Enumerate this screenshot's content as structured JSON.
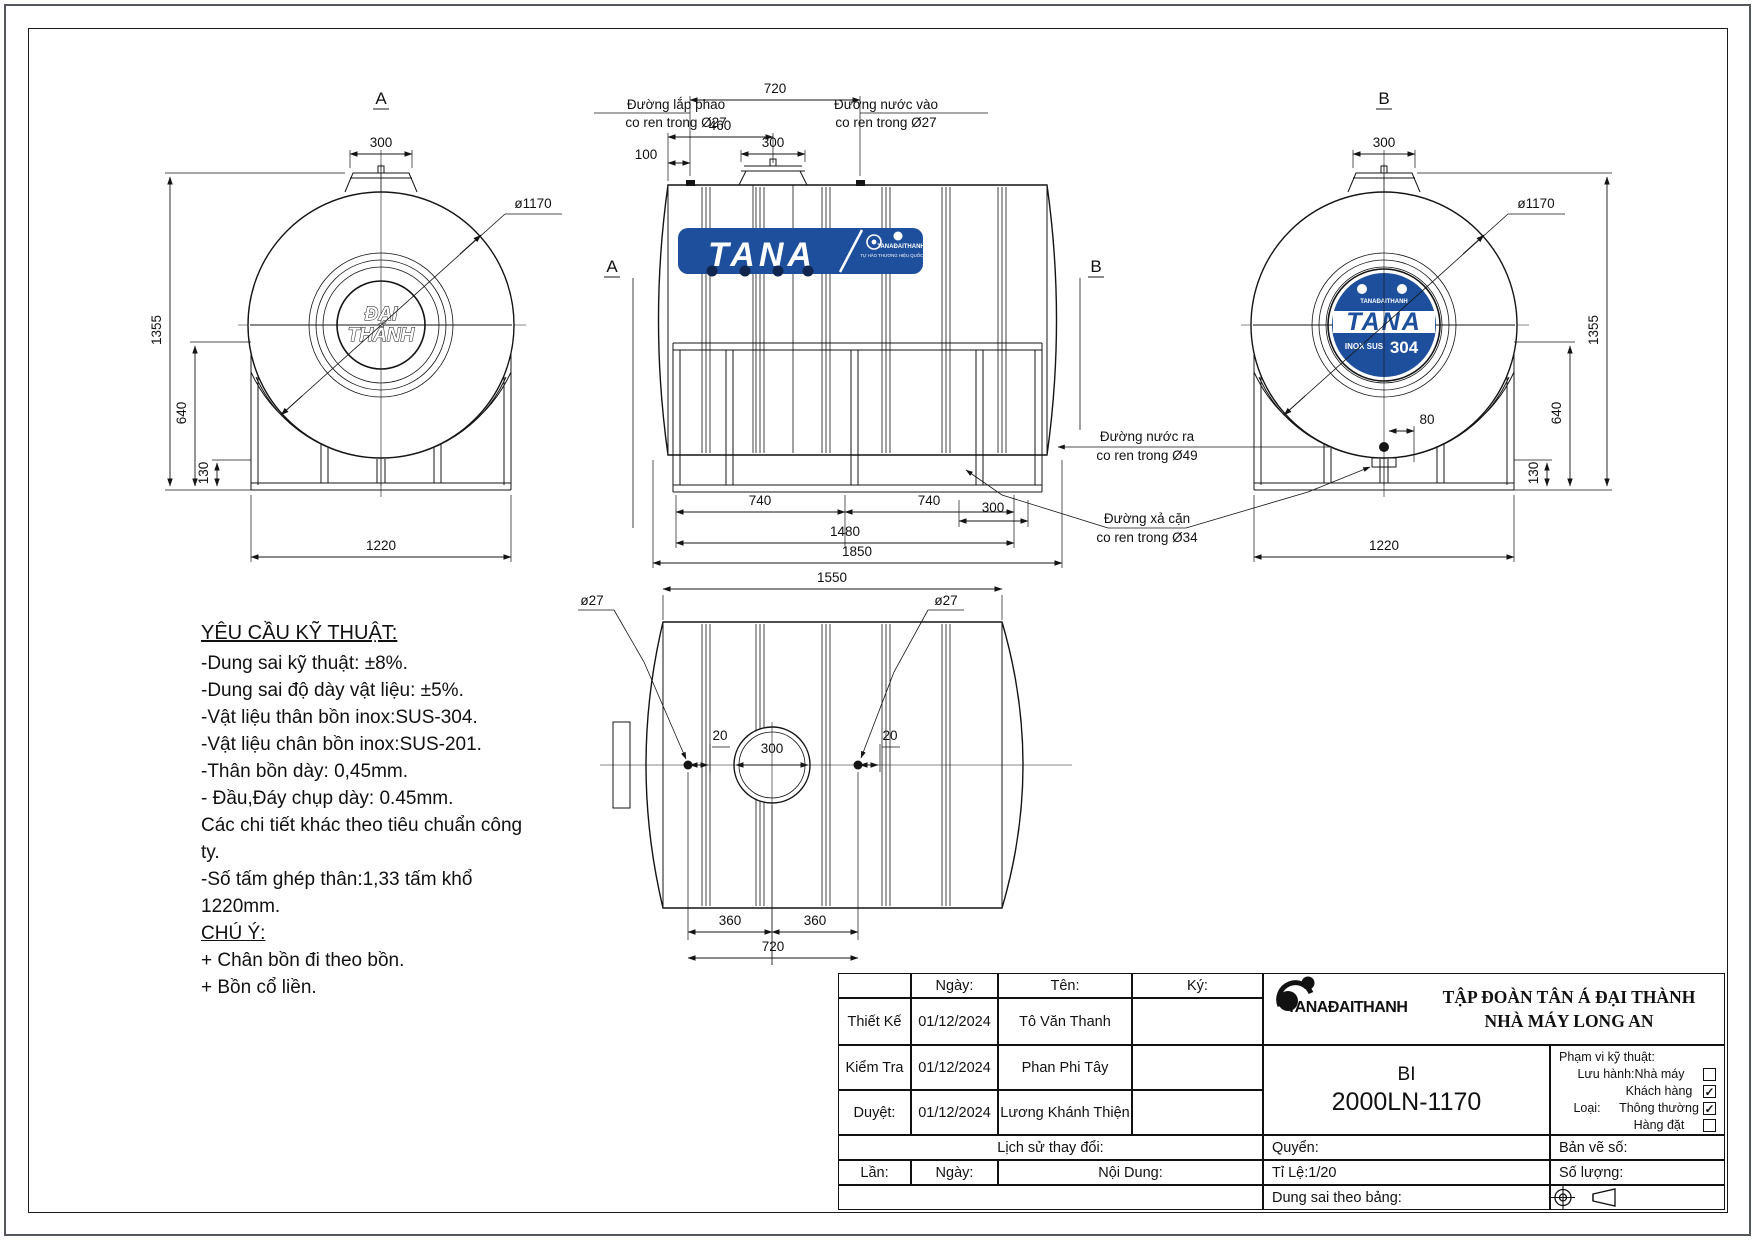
{
  "colors": {
    "brand_blue": "#1e4f9c",
    "line": "#141414",
    "background": "#ffffff"
  },
  "drawing": {
    "view_a": {
      "label": "A",
      "logo": [
        "ĐẠI",
        "THÀNH"
      ],
      "dims": {
        "lid": "300",
        "diameter": "ø1170",
        "height": "1355",
        "stand": "640",
        "leg": "130",
        "width": "1220"
      }
    },
    "front": {
      "brand": {
        "name": "TANA",
        "sub1": "TANAĐAITHANH",
        "sub2": "TỰ HÀO THƯƠNG HIỆU QUỐC GIA"
      },
      "labels": {
        "section_a": "A",
        "section_b": "B",
        "phao": [
          "Đường lắp phao",
          "co ren trong Ø27"
        ],
        "inlet": [
          "Đường nước vào",
          "co ren trong Ø27"
        ],
        "outlet": [
          "Đường nước ra",
          "co ren trong Ø49"
        ],
        "drain": [
          "Đường xả cặn",
          "co ren trong Ø34"
        ]
      },
      "dims": {
        "span": "720",
        "to_manhole": "460",
        "lid": "300",
        "end": "100",
        "leg_a": "740",
        "leg_b": "740",
        "drain": "300",
        "legs_span": "1480",
        "length": "1850"
      }
    },
    "view_b": {
      "label": "B",
      "brand": {
        "name": "TANA",
        "tiny": "TANAĐAITHANH",
        "inox": "INOX SUS",
        "grade": "304"
      },
      "dims": {
        "lid": "300",
        "diameter": "ø1170",
        "offset": "80",
        "height": "1355",
        "stand": "640",
        "leg": "130",
        "width": "1220"
      }
    },
    "top": {
      "dims": {
        "length": "1550",
        "hole": "300",
        "pitch_a": "360",
        "pitch_b": "360",
        "span": "720",
        "offset_l": "20",
        "offset_r": "20",
        "fitting_l": "ø27",
        "fitting_r": "ø27"
      }
    }
  },
  "tech": {
    "title": "YÊU CẦU KỸ THUẬT:",
    "lines": [
      "-Dung sai kỹ thuật: ±8%.",
      "-Dung sai độ dày vật liệu: ±5%.",
      "-Vật liệu thân bồn inox:SUS-304.",
      "-Vật liệu chân bồn inox:SUS-201.",
      "-Thân bồn dày: 0,45mm.",
      "- Đầu,Đáy chụp dày: 0.45mm.",
      "Các chi tiết khác theo tiêu chuẩn công ty.",
      "-Số tấm ghép thân:1,33 tấm khổ 1220mm."
    ],
    "note_title": "CHÚ Ý:",
    "notes": [
      "+ Chân bồn đi theo bồn.",
      "+ Bồn cổ liền."
    ]
  },
  "title_block": {
    "header": {
      "ngay": "Ngày:",
      "ten": "Tên:",
      "ky": "Ký:"
    },
    "rows": [
      {
        "role": "Thiết Kế",
        "date": "01/12/2024",
        "name": "Tô Văn Thanh"
      },
      {
        "role": "Kiểm Tra",
        "date": "01/12/2024",
        "name": "Phan Phi Tây"
      },
      {
        "role": "Duyệt:",
        "date": "01/12/2024",
        "name": "Lương Khánh Thiện"
      }
    ],
    "history": {
      "title": "Lịch sử thay đổi:",
      "lan": "Lần:",
      "ngay": "Ngày:",
      "noi_dung": "Nội Dung:"
    },
    "company": {
      "logo": "TANAĐAITHANH",
      "line1": "TẬP ĐOÀN TÂN Á ĐẠI THÀNH",
      "line2": "NHÀ MÁY LONG AN"
    },
    "product": {
      "code1": "BI",
      "code2": "2000LN-1170"
    },
    "fields": {
      "quyen": "Quyển:",
      "ti_le": "Tỉ Lệ:1/20",
      "dung_sai": "Dung sai theo bảng:",
      "ban_ve": "Bản vẽ số:",
      "so_luong": "Số lượng:"
    },
    "scope": {
      "title": "Phạm vi kỹ thuật:",
      "luu_hanh": "Lưu hành:Nhà máy",
      "khach_hang": "Khách hàng",
      "loai": "Loại:",
      "thong_thuong": "Thông thường",
      "hang_dat": "Hàng đặt",
      "checks": {
        "nha_may": "",
        "khach_hang": "✓",
        "thong_thuong": "✓",
        "hang_dat": ""
      }
    }
  }
}
